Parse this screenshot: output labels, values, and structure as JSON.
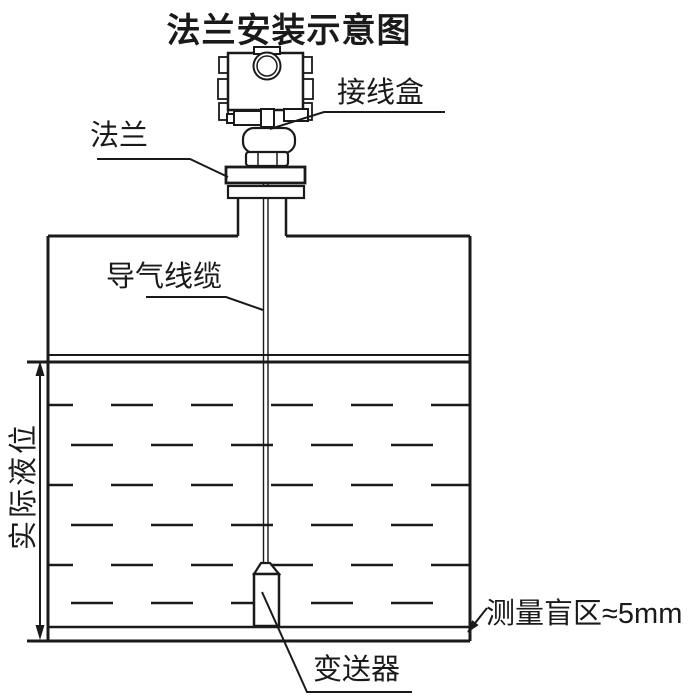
{
  "title": "法兰安装示意图",
  "labels": {
    "junction_box": "接线盒",
    "flange": "法兰",
    "air_cable": "导气线缆",
    "actual_level": "实际液位",
    "blind_zone": "测量盲区≈5mm",
    "transmitter": "变送器"
  },
  "colors": {
    "ink": "#1a1a1a",
    "background": "#ffffff"
  }
}
